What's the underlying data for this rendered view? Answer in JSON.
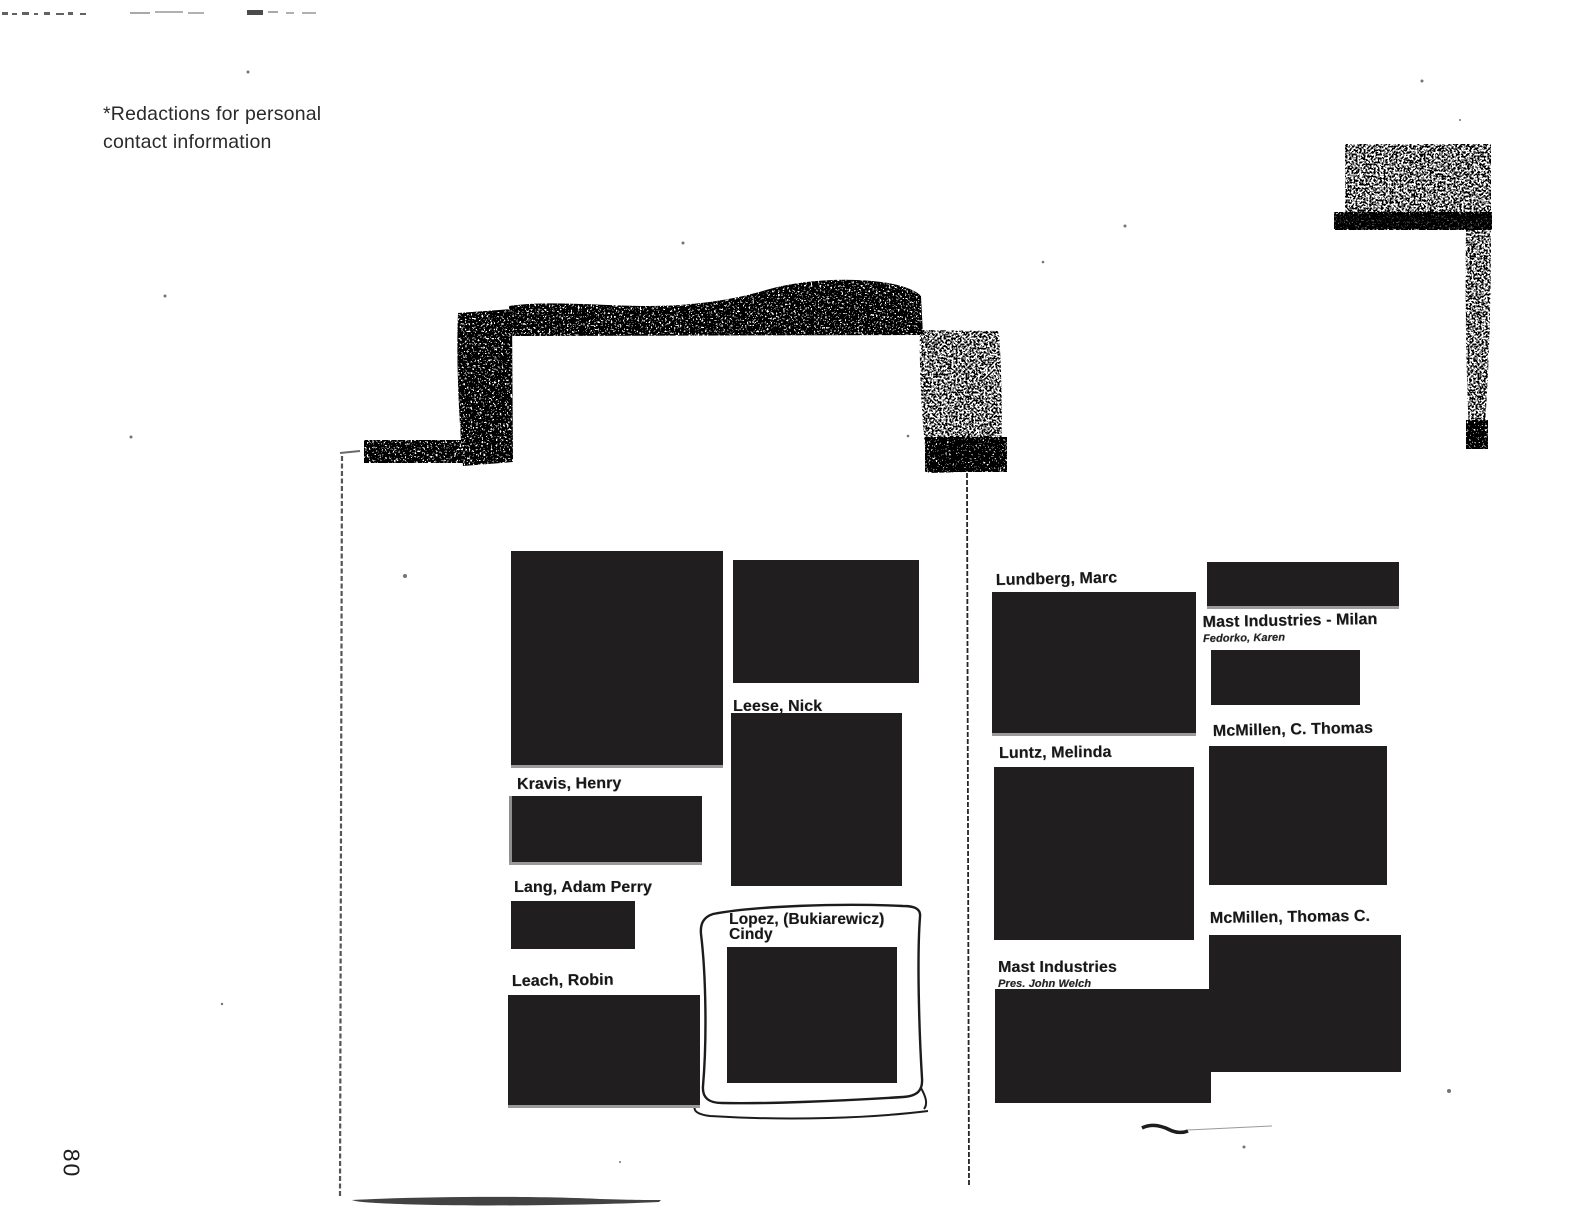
{
  "document": {
    "note_line1": "*Redactions for personal",
    "note_line2": "contact information",
    "page_number": "80"
  },
  "colors": {
    "paper": "#ffffff",
    "ink": "#1f1f1f",
    "redaction": "#201e1e"
  },
  "entries": [
    {
      "name": "Kravis, Henry"
    },
    {
      "name": "Lang, Adam Perry"
    },
    {
      "name": "Leach, Robin"
    },
    {
      "name": "Leese, Nick"
    },
    {
      "name": "Lopez, (Bukiarewicz)",
      "name2": "Cindy"
    },
    {
      "name": "Lundberg, Marc"
    },
    {
      "name": "Luntz, Melinda"
    },
    {
      "name": "Mast Industries",
      "sub": "Pres. John Welch"
    },
    {
      "name": "Mast Industries - Milan",
      "sub": "Fedorko, Karen"
    },
    {
      "name": "McMillen, C. Thomas"
    },
    {
      "name": "McMillen, Thomas C."
    }
  ]
}
